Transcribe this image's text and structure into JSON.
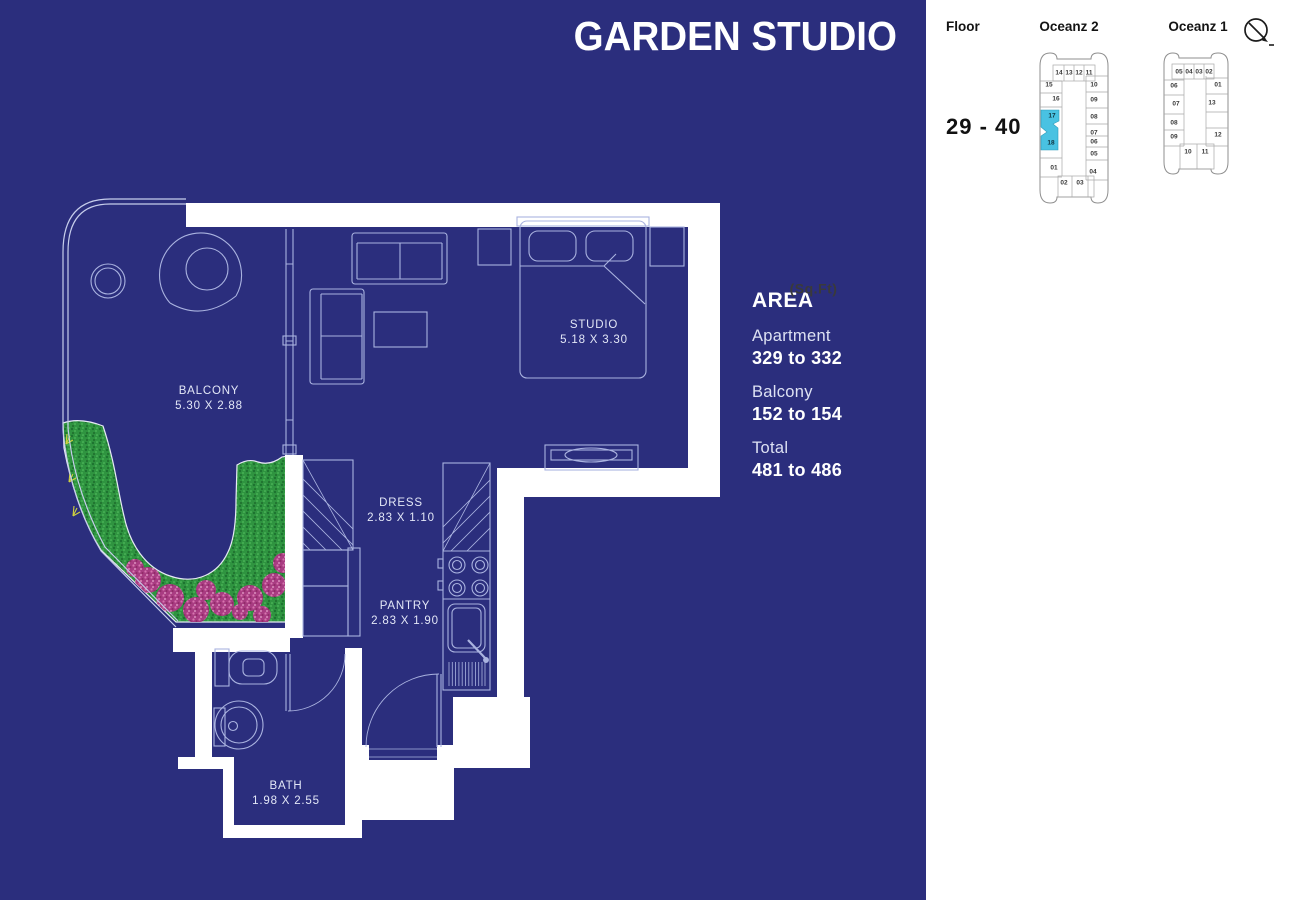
{
  "title": "GARDEN STUDIO",
  "colors": {
    "background": "#2b2e7d",
    "wall": "#ffffff",
    "line": "#aab3e0",
    "highlight_cyan": "#49c2e2",
    "garden_green": "#2f9440",
    "flower_pink": "#b2408a",
    "panel_bg": "#ffffff"
  },
  "plan": {
    "rooms": [
      {
        "name": "BALCONY",
        "dims": "5.30 X 2.88"
      },
      {
        "name": "STUDIO",
        "dims": "5.18 X 3.30"
      },
      {
        "name": "DRESS",
        "dims": "2.83 X 1.10"
      },
      {
        "name": "PANTRY",
        "dims": "2.83 X 1.90"
      },
      {
        "name": "BATH",
        "dims": "1.98 X 2.55"
      }
    ]
  },
  "area": {
    "heading": "AREA",
    "unit": "(Sq.Ft)",
    "rows": [
      {
        "label": "Apartment",
        "value": "329 to 332"
      },
      {
        "label": "Balcony",
        "value": "152 to 154"
      },
      {
        "label": "Total",
        "value": "481 to 486"
      }
    ]
  },
  "panel": {
    "floor_label": "Floor",
    "floor_range": "29 - 40",
    "compass_icon": "north-arrow-icon",
    "towers": [
      {
        "name": "Oceanz 2",
        "highlighted_units": [
          "17",
          "18"
        ],
        "units": [
          {
            "n": "14",
            "x": 23,
            "y": 25
          },
          {
            "n": "13",
            "x": 33,
            "y": 25
          },
          {
            "n": "12",
            "x": 43,
            "y": 25
          },
          {
            "n": "11",
            "x": 53,
            "y": 25
          },
          {
            "n": "15",
            "x": 13,
            "y": 37
          },
          {
            "n": "10",
            "x": 58,
            "y": 37
          },
          {
            "n": "16",
            "x": 20,
            "y": 51
          },
          {
            "n": "09",
            "x": 58,
            "y": 52
          },
          {
            "n": "17",
            "x": 16,
            "y": 68,
            "hl": true
          },
          {
            "n": "08",
            "x": 58,
            "y": 69
          },
          {
            "n": "07",
            "x": 58,
            "y": 85
          },
          {
            "n": "06",
            "x": 58,
            "y": 94
          },
          {
            "n": "18",
            "x": 15,
            "y": 95,
            "hl": true
          },
          {
            "n": "05",
            "x": 58,
            "y": 106
          },
          {
            "n": "01",
            "x": 18,
            "y": 120
          },
          {
            "n": "04",
            "x": 57,
            "y": 124
          },
          {
            "n": "02",
            "x": 28,
            "y": 135
          },
          {
            "n": "03",
            "x": 44,
            "y": 135
          }
        ]
      },
      {
        "name": "Oceanz 1",
        "highlighted_units": [],
        "units": [
          {
            "n": "05",
            "x": 19,
            "y": 24
          },
          {
            "n": "04",
            "x": 29,
            "y": 24
          },
          {
            "n": "03",
            "x": 39,
            "y": 24
          },
          {
            "n": "02",
            "x": 49,
            "y": 24
          },
          {
            "n": "06",
            "x": 14,
            "y": 38
          },
          {
            "n": "01",
            "x": 58,
            "y": 37
          },
          {
            "n": "07",
            "x": 16,
            "y": 56
          },
          {
            "n": "13",
            "x": 52,
            "y": 55
          },
          {
            "n": "08",
            "x": 14,
            "y": 75
          },
          {
            "n": "09",
            "x": 14,
            "y": 89
          },
          {
            "n": "12",
            "x": 58,
            "y": 87
          },
          {
            "n": "10",
            "x": 28,
            "y": 104
          },
          {
            "n": "11",
            "x": 45,
            "y": 104
          }
        ]
      }
    ]
  }
}
